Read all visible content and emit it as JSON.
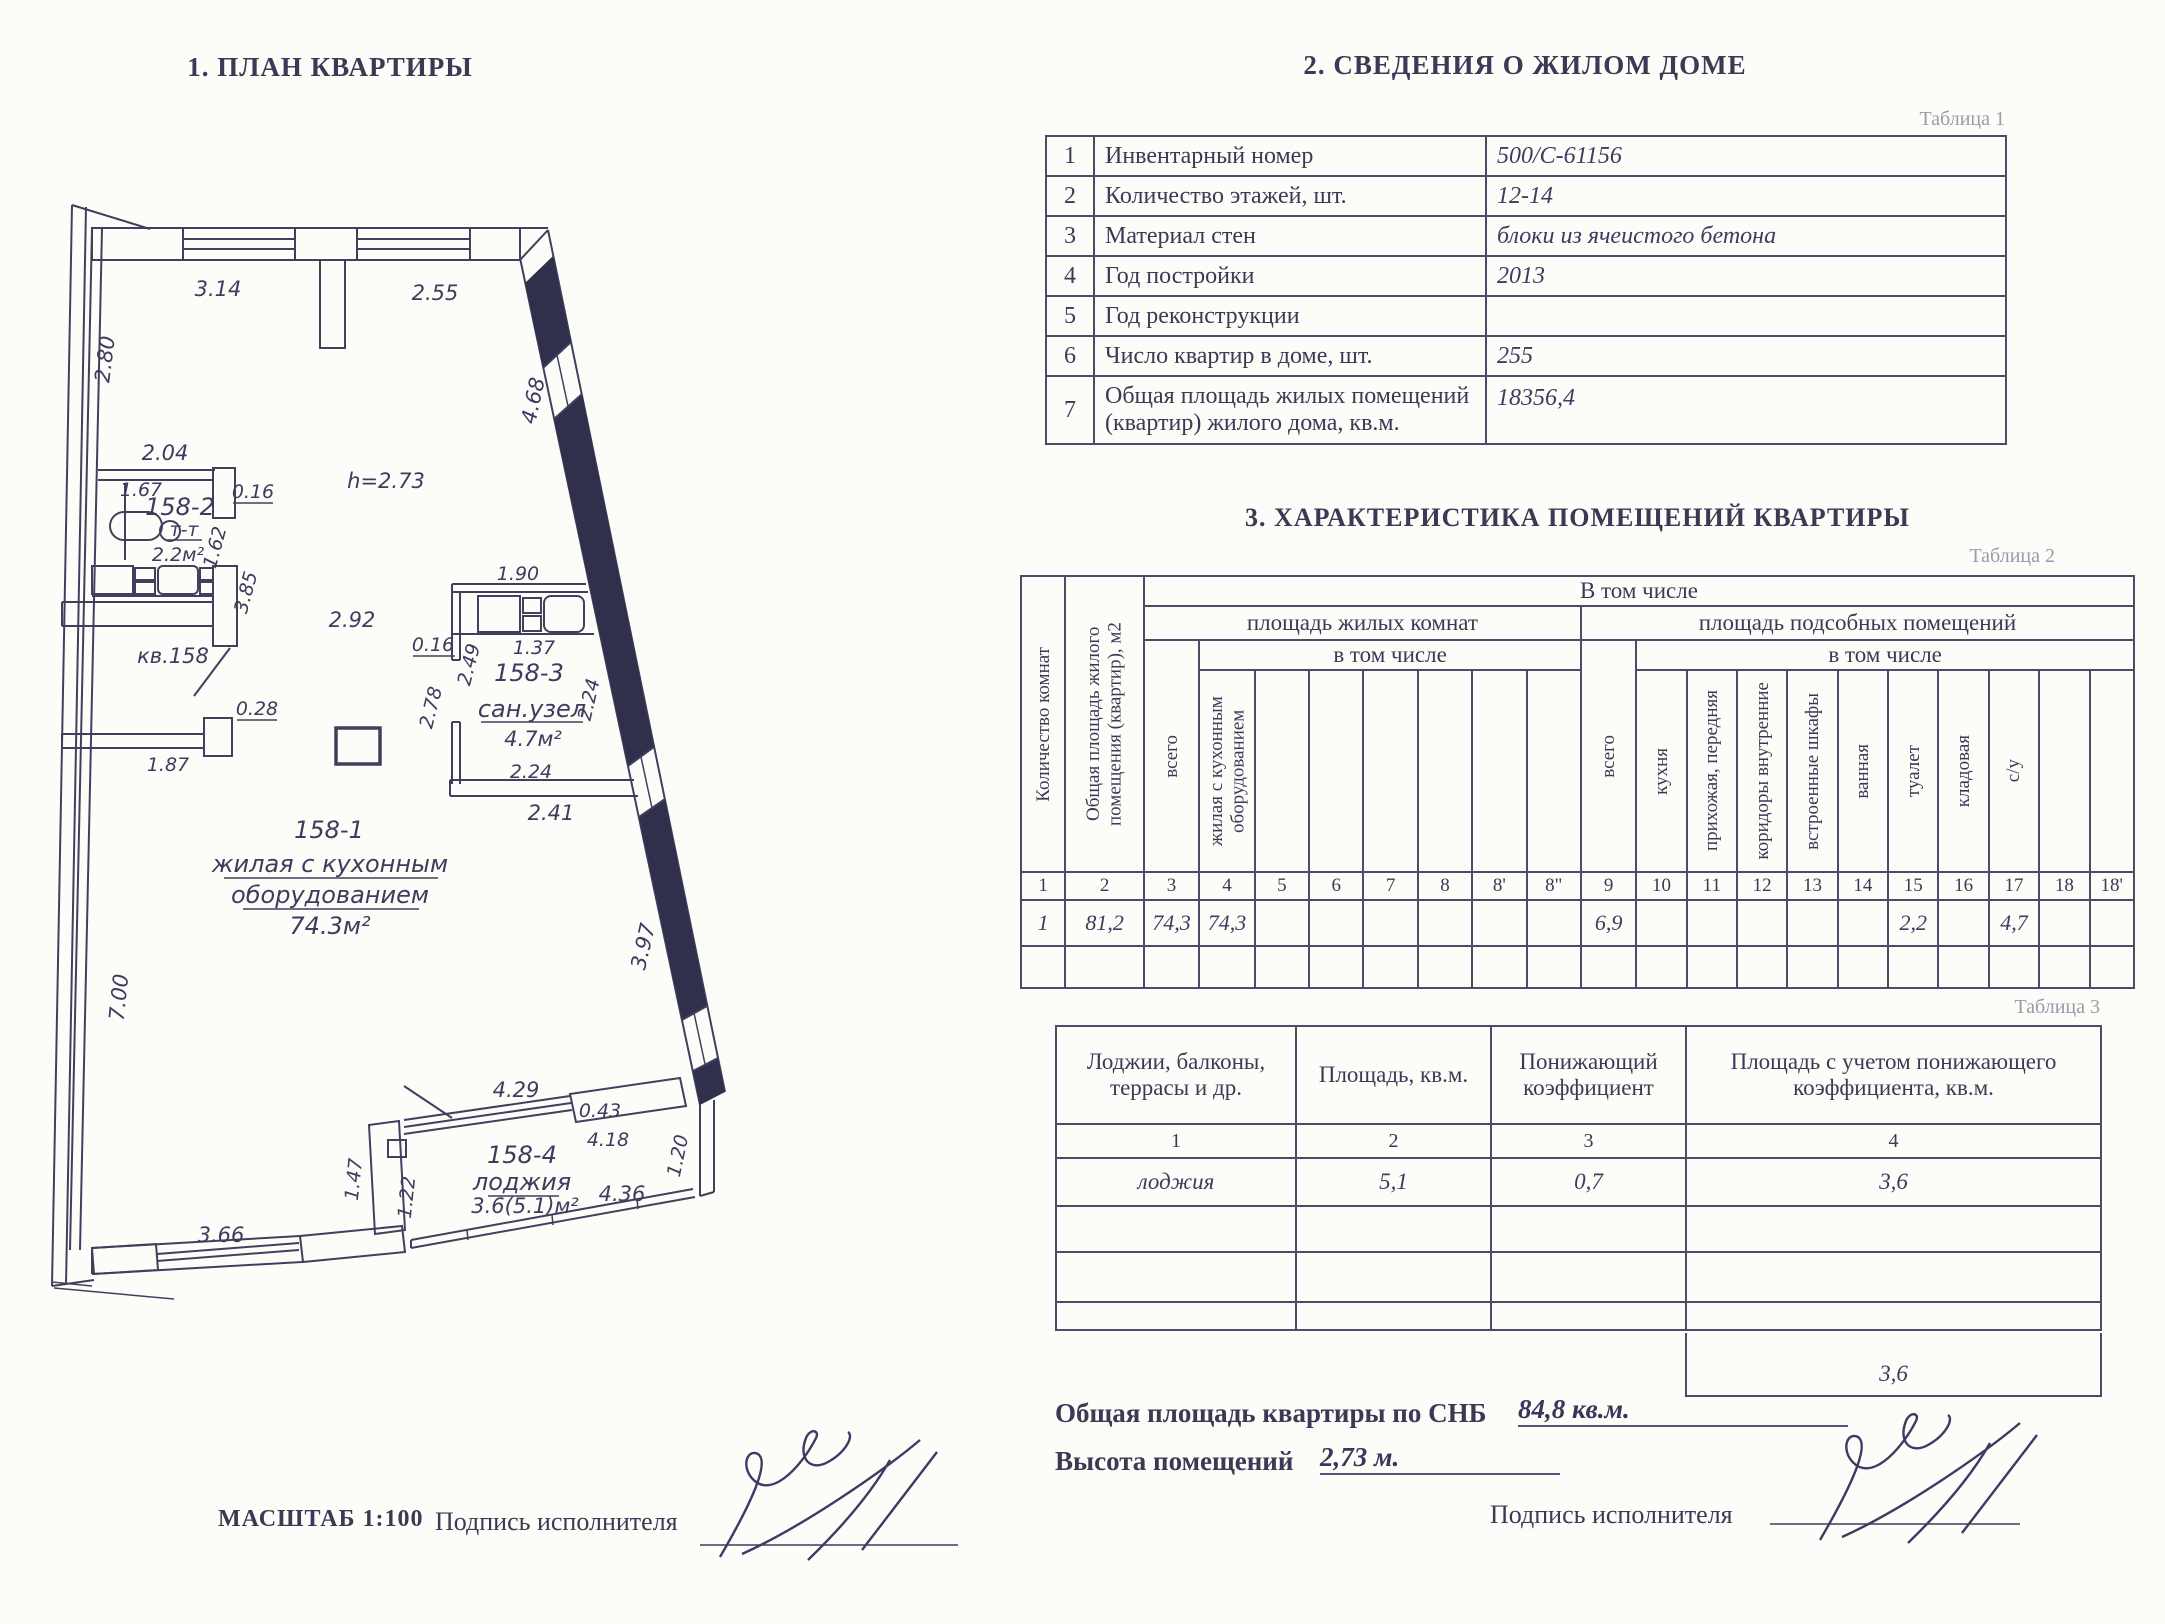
{
  "colors": {
    "ink": "#3d3d5c",
    "paper": "#fcfcf9",
    "table_border": "#4c4c68",
    "faint_label": "#9a9aa8"
  },
  "plan": {
    "title": "1. ПЛАН КВАРТИРЫ",
    "scale_label": "МАСШТАБ 1:100",
    "signature_label": "Подпись исполнителя",
    "dims": {
      "top_win1": "3.14",
      "top_win2": "2.55",
      "left_upper": "2.80",
      "slant_upper": "4.68",
      "kitchen_width": "2.04",
      "kitchen_inner_w": "1.67",
      "kitchen_wall": "0.16",
      "kitchen_num": "158-2",
      "kitchen_tt": "т-т",
      "kitchen_area": "2.2м²",
      "kitchen_d1": "1.62",
      "kitchen_d2": "3.85",
      "ceiling": "h=2.73",
      "passage": "2.92",
      "apt_label": "кв.158",
      "entry_step": "0.28",
      "entry_w": "1.87",
      "bath_top": "1.90",
      "bath_inner": "1.37",
      "bath_wall": "0.16",
      "bath_h1": "2.49",
      "bath_h2": "2.78",
      "bath_num": "158-3",
      "bath_name": "сан.узел",
      "bath_area": "4.7м²",
      "bath_w": "2.24",
      "bath_bottom": "2.41",
      "slant_mid": "2.24",
      "slant_lower": "3.97",
      "room_num": "158-1",
      "room_name1": "жилая с кухонным",
      "room_name2": "оборудованием",
      "room_area": "74.3м²",
      "left_lower": "7.00",
      "loggia_top": "4.29",
      "loggia_pier": "0.43",
      "loggia_inner": "4.18",
      "loggia_num": "158-4",
      "loggia_name": "лоджия",
      "loggia_area": "3.6(5.1)м²",
      "loggia_bottom": "4.36",
      "loggia_right": "1.20",
      "loggia_left1": "1.47",
      "loggia_left2": "1.22",
      "bottom_win": "3.66"
    }
  },
  "building_info": {
    "title": "2. СВЕДЕНИЯ О ЖИЛОМ ДОМЕ",
    "table_label": "Таблица 1",
    "rows": [
      {
        "num": "1",
        "label": "Инвентарный номер",
        "value": "500/С-61156"
      },
      {
        "num": "2",
        "label": "Количество этажей, шт.",
        "value": "12-14"
      },
      {
        "num": "3",
        "label": "Материал стен",
        "value": "блоки из ячеистого бетона"
      },
      {
        "num": "4",
        "label": "Год постройки",
        "value": "2013"
      },
      {
        "num": "5",
        "label": "Год реконструкции",
        "value": ""
      },
      {
        "num": "6",
        "label": "Число квартир в доме, шт.",
        "value": "255"
      },
      {
        "num": "7",
        "label": "Общая площадь жилых помещений (квартир) жилого дома, кв.м.",
        "value": "18356,4"
      }
    ]
  },
  "characteristics": {
    "title": "3. ХАРАКТЕРИСТИКА ПОМЕЩЕНИЙ КВАРТИРЫ",
    "table_label": "Таблица 2",
    "header_top": "В том числе",
    "living": "площадь жилых комнат",
    "aux": "площадь подсобных помещений",
    "incl": "в том числе",
    "incl2": "в том числе",
    "col_rooms": "Количество комнат",
    "col_total_area": "Общая площадь жилого помещения (квартир), м2",
    "col_vsego": "всего",
    "col_vsego2": "всего",
    "col_living_kitchen": "жилая с кухонным оборудованием",
    "col_kitchen": "кухня",
    "col_hall": "прихожая, передняя",
    "col_corridors": "коридоры внутренние",
    "col_wardrobes": "встроенные шкафы",
    "col_bath": "ванная",
    "col_toilet": "туалет",
    "col_storage": "кладовая",
    "col_su": "с/у",
    "numbering": [
      "1",
      "2",
      "3",
      "4",
      "5",
      "6",
      "7",
      "8",
      "8'",
      "8\"",
      "9",
      "10",
      "11",
      "12",
      "13",
      "14",
      "15",
      "16",
      "17",
      "18",
      "18'"
    ],
    "data_row": [
      "1",
      "81,2",
      "74,3",
      "74,3",
      "",
      "",
      "",
      "",
      "",
      "",
      "6,9",
      "",
      "",
      "",
      "",
      "",
      "2,2",
      "",
      "4,7",
      "",
      ""
    ]
  },
  "loggia_table": {
    "table_label": "Таблица 3",
    "headers": [
      "Лоджии, балконы, террасы и др.",
      "Площадь, кв.м.",
      "Понижающий коэффициент",
      "Площадь с учетом понижающего коэффициента, кв.м."
    ],
    "numbering": [
      "1",
      "2",
      "3",
      "4"
    ],
    "row": [
      "лоджия",
      "5,1",
      "0,7",
      "3,6"
    ],
    "total": "3,6"
  },
  "footer": {
    "total_area_label": "Общая площадь квартиры по СНБ",
    "total_area_value": "84,8 кв.м.",
    "height_label": "Высота помещений",
    "height_value": "2,73 м.",
    "signature_label": "Подпись исполнителя"
  }
}
